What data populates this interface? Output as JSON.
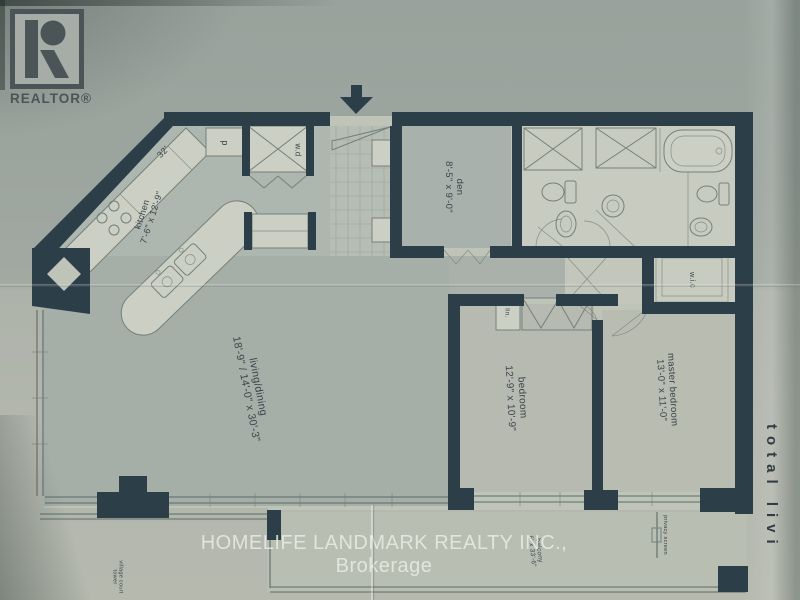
{
  "logo": {
    "text": "REALTOR®"
  },
  "watermark": {
    "text": "HOMELIFE LANDMARK REALTY INC., Brokerage"
  },
  "side_text": {
    "text": "total livi"
  },
  "labels": {
    "wall_dim": "32'",
    "pantry": "p",
    "washer_dryer": "w.d",
    "kitchen": {
      "name": "kitchen",
      "dims": "7'-6\" x 12'-9\""
    },
    "den": {
      "name": "den",
      "dims": "8'-5\" x 9'-0\""
    },
    "linen": "lin.",
    "wic": "w.i.c",
    "living": {
      "name": "living/dining",
      "dims": "18'-9\" / 14'-0\" x 30'-3\""
    },
    "bedroom": {
      "name": "bedroom",
      "dims": "12'-9\" x 10'-9\""
    },
    "master": {
      "name": "master bedroom",
      "dims": "13'-0\" x 11'-0\""
    },
    "balcony": {
      "name": "balcony",
      "dims": "6' x 33'-6\""
    },
    "privacy": "privacy screen",
    "building": {
      "line1": "village court",
      "line2": "tower"
    }
  },
  "colors": {
    "wall": "#2c3e48",
    "line": "#74807a",
    "fixfill": "#cbcfc4",
    "winline": "#5f6b66",
    "paper": "#aab0a8"
  }
}
